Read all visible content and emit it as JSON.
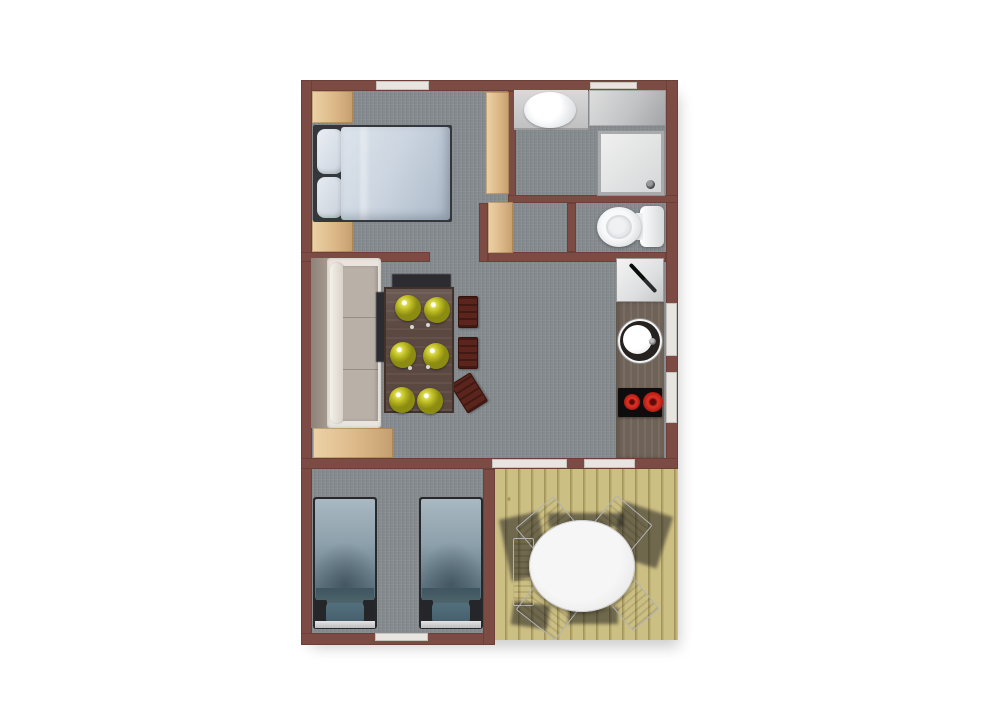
{
  "page": {
    "title": "Studio cabin floor plan – top-down 3D render",
    "background": "#ffffff"
  },
  "palette": {
    "wall": "#7c4b43",
    "carpet": "#83898c",
    "wood_trim": "#ddba8e",
    "deck_planks": "#c6b97c",
    "opening_white": "#e8e5e0",
    "bed_double_duvet": "#c9d3de",
    "bed_single_duvet": "#7e93a0",
    "sofa": "#b9b1a8",
    "dining_table": "#5b4840",
    "plate_accent": "#bcbb22",
    "dining_chair": "#5b241c",
    "stove_burner": "#d32b20",
    "patio_table": "#efefef"
  },
  "rooms": [
    {
      "name": "bedroom-double",
      "furniture": [
        "double-bed",
        "pillow",
        "pillow",
        "nightstand",
        "nightstand",
        "closet-door"
      ]
    },
    {
      "name": "bathroom",
      "furniture": [
        "vanity-sink",
        "storage-cabinet",
        "shower-tray"
      ]
    },
    {
      "name": "wc",
      "furniture": [
        "toilet"
      ]
    },
    {
      "name": "living-dining",
      "furniture": [
        "sofa",
        "dining-table",
        "plate x6",
        "dining-chair x3",
        "wood-sideboard"
      ]
    },
    {
      "name": "kitchen",
      "furniture": [
        "cutting-board-with-knife",
        "round-sink",
        "two-burner-stove",
        "counter"
      ]
    },
    {
      "name": "bedroom-twin",
      "furniture": [
        "single-bed",
        "single-bed"
      ]
    },
    {
      "name": "deck",
      "furniture": [
        "round-patio-table",
        "patio-chair x5"
      ]
    }
  ],
  "openings": {
    "windows": [
      "top-bedroom",
      "top-bathroom",
      "right-kitchen-1",
      "right-kitchen-2",
      "bottom-bedroom"
    ],
    "doors_to_deck": [
      "living-south-1",
      "living-south-2"
    ]
  }
}
